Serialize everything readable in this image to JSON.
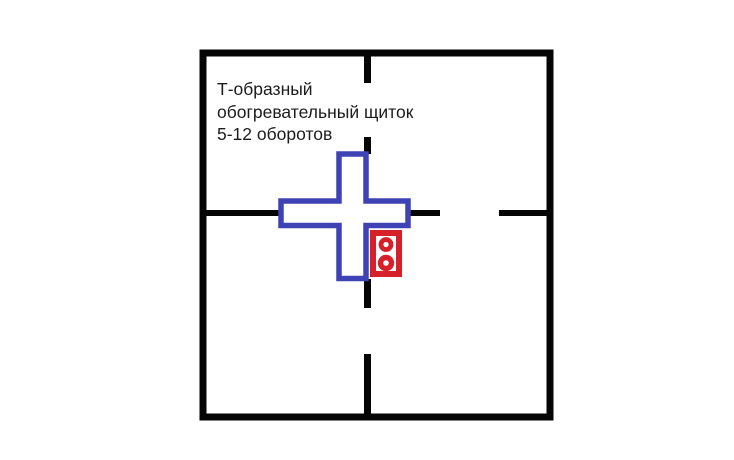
{
  "diagram": {
    "annotation": {
      "line1": "Т-образный",
      "line2": "обогревательный щиток",
      "line3": "5-12 оборотов"
    },
    "colors": {
      "walls": "#050505",
      "heating_panel": "#3e42b4",
      "stove": "#d6202a",
      "text": "#1c1c1c",
      "background": "#ffffff"
    },
    "icons": {
      "heating_panel": "cross-outline-icon",
      "stove": "two-burner-stove-icon"
    }
  }
}
